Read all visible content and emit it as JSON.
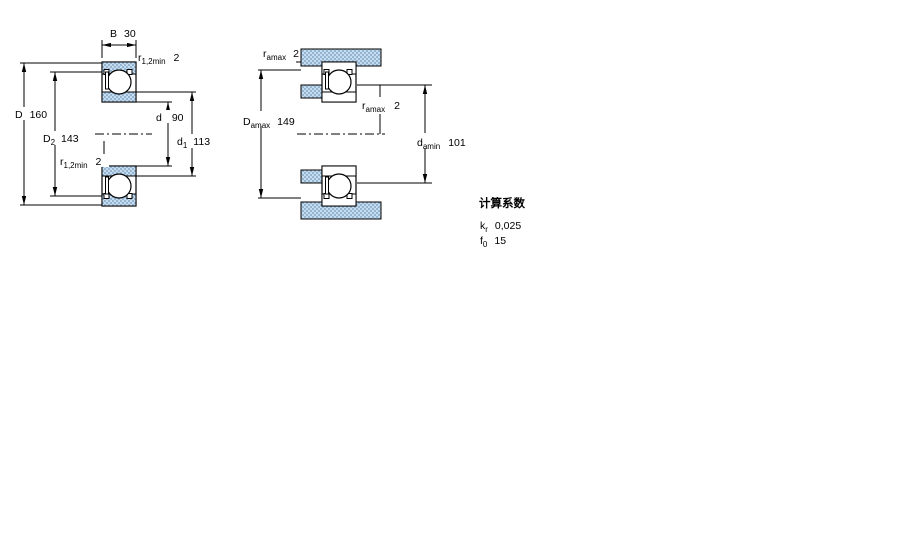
{
  "page": {
    "background": "#ffffff"
  },
  "colors": {
    "line": "#000000",
    "hatch_base": "#c7dcee",
    "hatch_dot": "#93b5d2"
  },
  "view1": {
    "name": "bearing-cross-section-view",
    "dim_B": {
      "label": "B",
      "value": "30"
    },
    "dim_r_top": {
      "label": "r",
      "sub": "1,2min",
      "value": "2"
    },
    "dim_D": {
      "label": "D",
      "value": "160"
    },
    "dim_D2": {
      "label": "D",
      "sub": "2",
      "value": "143"
    },
    "dim_d": {
      "label": "d",
      "value": "90"
    },
    "dim_d1": {
      "label": "d",
      "sub": "1",
      "value": "113"
    },
    "dim_r_mid": {
      "label": "r",
      "sub": "1,2min",
      "value": "2"
    }
  },
  "view2": {
    "name": "mounting-dimensions-view",
    "dim_r_top": {
      "label": "r",
      "sub": "amax",
      "value": "2"
    },
    "dim_Damax": {
      "label": "D",
      "sub": "amax",
      "value": "149"
    },
    "dim_r_mid": {
      "label": "r",
      "sub": "amax",
      "value": "2"
    },
    "dim_damin": {
      "label": "d",
      "sub": "amin",
      "value": "101"
    }
  },
  "calculation_factors": {
    "title": "计算系数",
    "kr": {
      "label": "k",
      "sub": "r",
      "value": "0,025"
    },
    "f0": {
      "label": "f",
      "sub": "0",
      "value": "15"
    }
  }
}
